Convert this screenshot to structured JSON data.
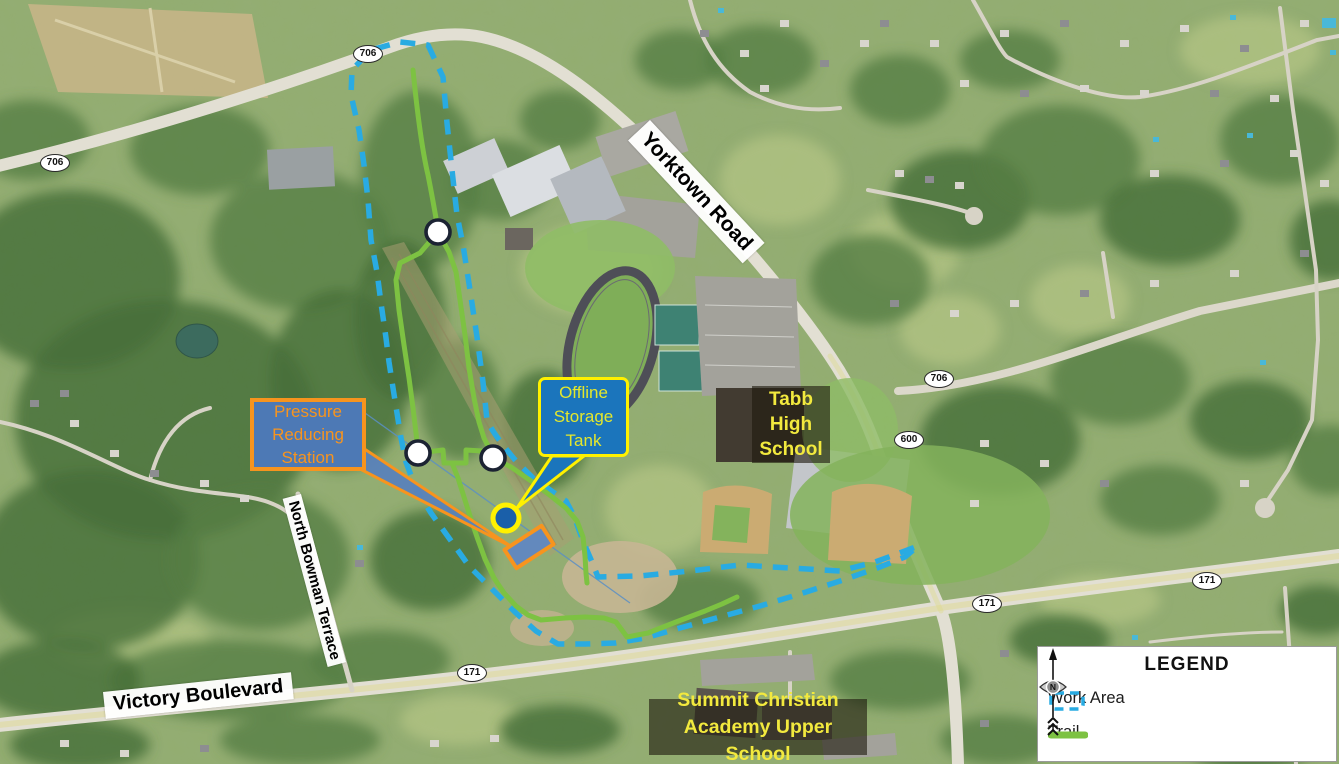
{
  "legend": {
    "title": "LEGEND",
    "items": [
      {
        "label": "Work Area",
        "symbol": "dashed-outline",
        "color": "#29ABE2"
      },
      {
        "label": "Trail",
        "symbol": "solid-line",
        "color": "#7DC242"
      }
    ],
    "compass_letter": "N"
  },
  "labels": {
    "pressure_reducing_station": "Pressure Reducing Station",
    "offline_storage_tank": "Offline Storage Tank",
    "tabb_high_school": "Tabb High School",
    "summit_christian": "Summit Christian Academy Upper School",
    "yorktown_road": "Yorktown Road",
    "victory_boulevard": "Victory Boulevard",
    "north_bowman_terrace": "North Bowman Terrace"
  },
  "route_shields": [
    {
      "number": "706",
      "x": 368,
      "y": 54
    },
    {
      "number": "706",
      "x": 55,
      "y": 163
    },
    {
      "number": "706",
      "x": 939,
      "y": 379
    },
    {
      "number": "600",
      "x": 909,
      "y": 440
    },
    {
      "number": "171",
      "x": 472,
      "y": 673
    },
    {
      "number": "171",
      "x": 987,
      "y": 604
    },
    {
      "number": "171",
      "x": 1207,
      "y": 581
    }
  ],
  "colors": {
    "work_area": "#29ABE2",
    "trail": "#7DC242",
    "callout_orange": "#F7941E",
    "callout_yellow": "#FFF100",
    "school_label_yellow": "#F2E93E",
    "tank_fill": "#1A5FA9"
  }
}
